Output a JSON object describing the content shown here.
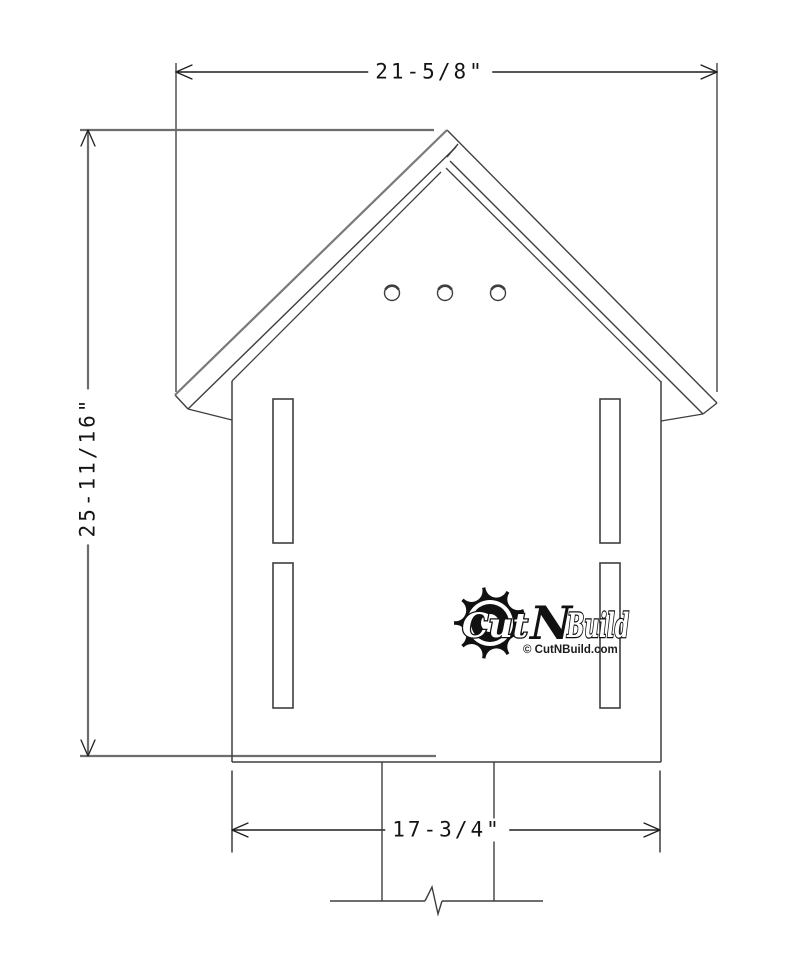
{
  "canvas": {
    "width": 812,
    "height": 964,
    "background": "#ffffff"
  },
  "dimensions": {
    "top": {
      "label": "21-5/8\""
    },
    "left": {
      "label": "25-11/16\""
    },
    "bottom": {
      "label": "17-3/4\""
    }
  },
  "features": {
    "entry_holes": 3,
    "side_slots": 4,
    "mounting_post_with_break_symbol": true
  },
  "logo": {
    "word1": "Cut",
    "word2": "N",
    "word3": "Build",
    "subtitle": "© CutNBuild.com"
  },
  "colors": {
    "model_line": "#3f3f3f",
    "gray_line": "#6e6e6e",
    "dim_line": "#1f1f1f",
    "text": "#141414",
    "logo_black": "#111111"
  }
}
